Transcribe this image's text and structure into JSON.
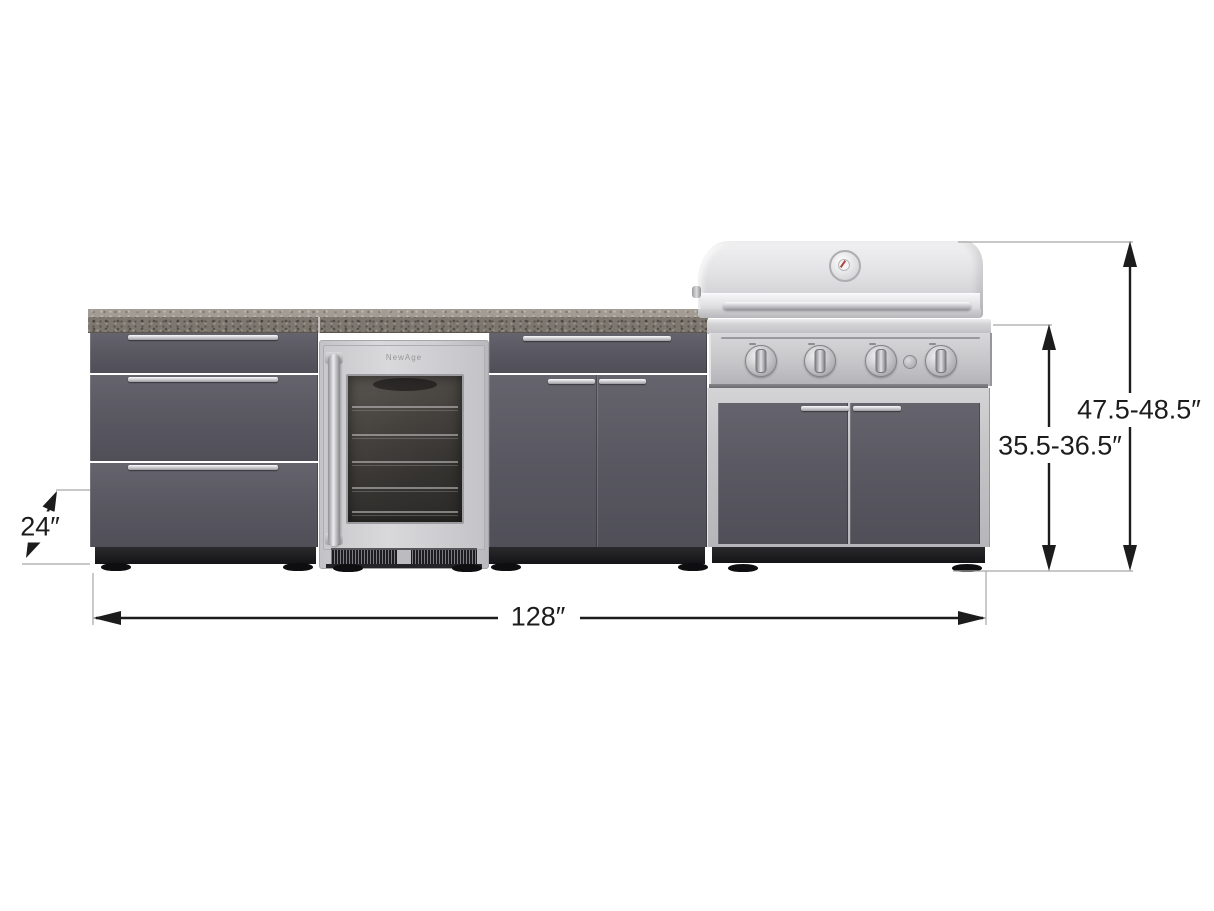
{
  "labels": {
    "total_width": "128″",
    "depth": "24″",
    "counter_height": "35.5-36.5″",
    "overall_height": "47.5-48.5″"
  },
  "fridge": {
    "brand": "NewAge"
  },
  "icons": {
    "thermometer": "thermometer-icon",
    "burner_knob": "burner-knob-icon",
    "igniter": "igniter-button-icon"
  },
  "colors": {
    "background": "#ffffff",
    "cabinet_gray": "#58575f",
    "stainless_light": "#d6d6d8",
    "countertop_speckled": "#7e776f",
    "toe_kick_black": "#1b1b1d",
    "dimension_ink": "#1c1c1c"
  }
}
